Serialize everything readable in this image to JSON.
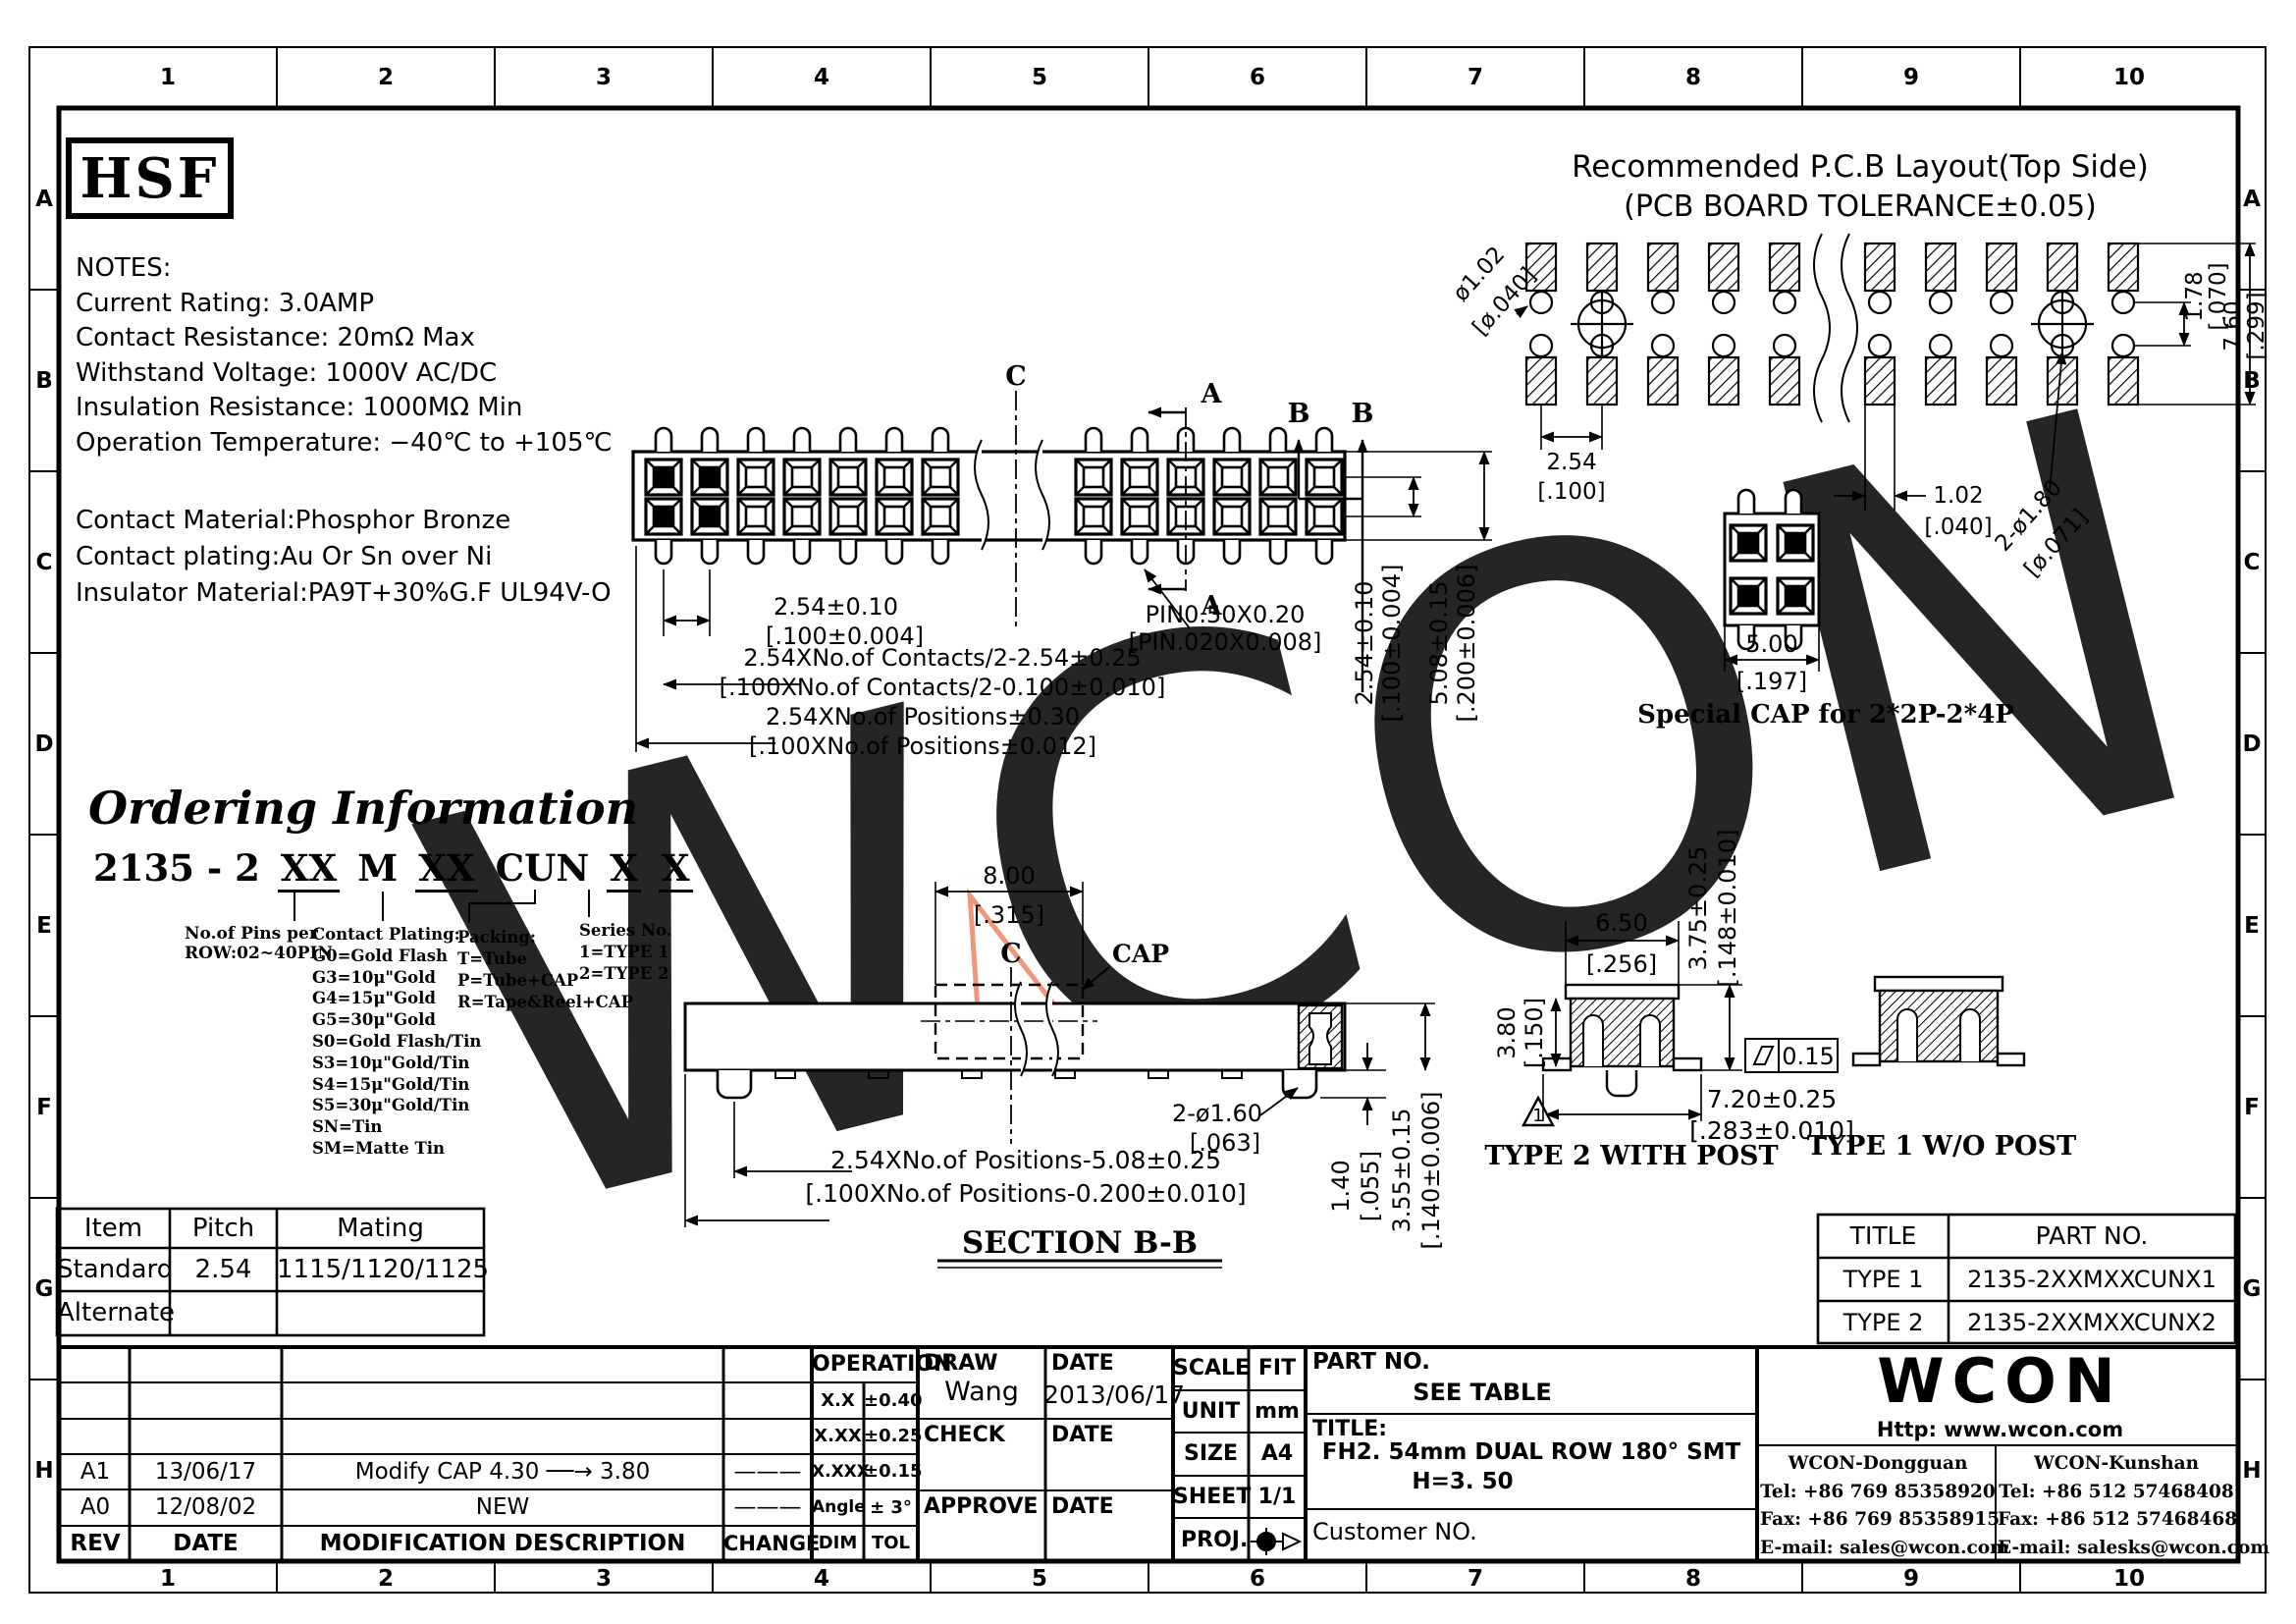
{
  "ruler": {
    "cols": [
      "1",
      "2",
      "3",
      "4",
      "5",
      "6",
      "7",
      "8",
      "9",
      "10"
    ],
    "rows": [
      "A",
      "B",
      "C",
      "D",
      "E",
      "F",
      "G",
      "H"
    ]
  },
  "brand": {
    "logo": "HSF"
  },
  "notes": {
    "title": "NOTES:",
    "lines": [
      "Current Rating: 3.0AMP",
      "Contact Resistance: 20mΩ Max",
      "Withstand Voltage: 1000V AC/DC",
      "Insulation Resistance: 1000MΩ Min",
      "Operation Temperature: −40℃ to +105℃"
    ]
  },
  "material": {
    "lines": [
      "Contact Material:Phosphor Bronze",
      "Contact plating:Au Or Sn over Ni",
      "Insulator Material:PA9T+30%G.F UL94V-O"
    ]
  },
  "ordering": {
    "title": "Ordering Information",
    "pn_prefix": "2135 - 2",
    "pn_pins": "XX",
    "pn_m": "M",
    "pn_plating": "XX",
    "pn_cun": "CUN",
    "pn_packing": "X",
    "pn_series": "X",
    "pins_note": [
      "No.of Pins per",
      "ROW:02~40PIN"
    ],
    "plating_title": "Contact Plating:",
    "plating_options": [
      "G0=Gold Flash",
      "G3=10μ\"Gold",
      "G4=15μ\"Gold",
      "G5=30μ\"Gold",
      "S0=Gold Flash/Tin",
      "S3=10μ\"Gold/Tin",
      "S4=15μ\"Gold/Tin",
      "S5=30μ\"Gold/Tin",
      "SN=Tin",
      "SM=Matte Tin"
    ],
    "packing_title": "Packing:",
    "packing_options": [
      "T=Tube",
      "P=Tube+CAP",
      "R=Tape&Reel+CAP"
    ],
    "series_title": "Series No.",
    "series_options": [
      "1=TYPE 1",
      "2=TYPE 2"
    ]
  },
  "pcb": {
    "title": "Recommended P.C.B Layout(Top Side)",
    "subtitle": "(PCB BOARD TOLERANCE±0.05)",
    "hole_mm": "ø1.02",
    "hole_in": "[ø.040]",
    "pitch_mm": "2.54",
    "pitch_in": "[.100]",
    "pad_mm": "1.02",
    "pad_in": "[.040]",
    "post_mm": "2-ø1.80",
    "post_in": "[ø.071]",
    "gap_mm": "1.78",
    "gap_in": "[.070]",
    "span_mm": "7.60",
    "span_in": "[.299]"
  },
  "top_view": {
    "sec_c": "C",
    "sec_a": "A",
    "sec_b": "B",
    "pins": [
      "2",
      "4",
      "1",
      "3"
    ],
    "pitch_mm": "2.54±0.10",
    "pitch_in": "[.100±0.004]",
    "pin_mm": "PIN0.50X0.20",
    "pin_in": "[PIN.020X0.008]",
    "contacts_mm": "2.54XNo.of Contacts/2-2.54±0.25",
    "contacts_in": "[.100XNo.of Contacts/2-0.100±0.010]",
    "positions_mm": "2.54XNo.of Positions±0.30",
    "positions_in": "[.100XNo.of Positions±0.012]",
    "row_mm": "2.54±0.10",
    "row_in": "[.100±0.004]",
    "width_mm": "5.08±0.15",
    "width_in": "[.200±0.006]"
  },
  "special_cap": {
    "pins": [
      "2",
      "4",
      "1",
      "3"
    ],
    "w_mm": "5.00",
    "w_in": "[.197]",
    "caption": "Special CAP for 2*2P-2*4P"
  },
  "section_bb": {
    "label": "SECTION B-B",
    "c": "C",
    "cap": "CAP",
    "cap_w_mm": "8.00",
    "cap_w_in": "[.315]",
    "len_mm": "2.54XNo.of Positions-5.08±0.25",
    "len_in": "[.100XNo.of Positions-0.200±0.010]",
    "post_mm": "2-ø1.60",
    "post_in": "[.063]",
    "post_h_mm": "1.40",
    "post_h_in": "[.055]",
    "h_mm": "3.55±0.15",
    "h_in": "[.140±0.006]"
  },
  "type2": {
    "caption": "TYPE 2 WITH POST",
    "rev": "1",
    "w_mm": "6.50",
    "w_in": "[.256]",
    "h_mm": "3.80",
    "h_in": "[.150]",
    "oh_mm": "3.75±0.25",
    "oh_in": "[.148±0.010]",
    "span_mm": "7.20±0.25",
    "span_in": "[.283±0.010]",
    "flatness": "0.15"
  },
  "type1": {
    "caption": "TYPE 1 W/O POST"
  },
  "mating_table": {
    "headers": [
      "Item",
      "Pitch",
      "Mating"
    ],
    "rows": [
      [
        "Standard",
        "2.54",
        "1115/1120/1125"
      ],
      [
        "Alternate",
        "",
        ""
      ]
    ]
  },
  "part_table": {
    "headers": [
      "TITLE",
      "PART NO."
    ],
    "rows": [
      [
        "TYPE 1",
        "2135-2XXMXXCUNX1"
      ],
      [
        "TYPE 2",
        "2135-2XXMXXCUNX2"
      ]
    ]
  },
  "title_block": {
    "rev_headers": [
      "REV",
      "DATE",
      "MODIFICATION DESCRIPTION",
      "CHANGE"
    ],
    "revisions": [
      [
        "A1",
        "13/06/17",
        "Modify CAP 4.30 ──→ 3.80",
        "———"
      ],
      [
        "A0",
        "12/08/02",
        "NEW",
        "———"
      ]
    ],
    "tol_header": "OPERATION",
    "tol_rows": [
      [
        "X.X",
        "±0.40"
      ],
      [
        "X.XX",
        "±0.25"
      ],
      [
        "X.XXX",
        "±0.15"
      ],
      [
        "Angle",
        "± 3°"
      ],
      [
        "DIM",
        "TOL"
      ]
    ],
    "draw_label": "DRAW",
    "draw_name": "Wang",
    "date_label": "DATE",
    "draw_date": "2013/06/17",
    "check_label": "CHECK",
    "approve_label": "APPROVE",
    "scale_label": "SCALE",
    "scale": "FIT",
    "unit_label": "UNIT",
    "unit": "mm",
    "size_label": "SIZE",
    "size": "A4",
    "sheet_label": "SHEET",
    "sheet": "1/1",
    "proj_label": "PROJ.",
    "part_no_label": "PART NO.",
    "part_no": "SEE TABLE",
    "title_label": "TITLE:",
    "title1": "FH2. 54mm DUAL ROW 180° SMT",
    "title2": "H=3. 50",
    "customer": "Customer NO.",
    "wcon_logo": "WCON",
    "url": "Http: www.wcon.com",
    "dongguan": [
      "WCON-Dongguan",
      "Tel: +86 769 85358920",
      "Fax: +86 769 85358915",
      "E-mail: sales@wcon.com"
    ],
    "kunshan": [
      "WCON-Kunshan",
      "Tel: +86 512 57468408",
      "Fax: +86 512 57468468",
      "E-mail: salesks@wcon.com"
    ]
  },
  "watermark": {
    "text": "WCON",
    "color": "#b9bacd",
    "accent": "#ee8565"
  }
}
